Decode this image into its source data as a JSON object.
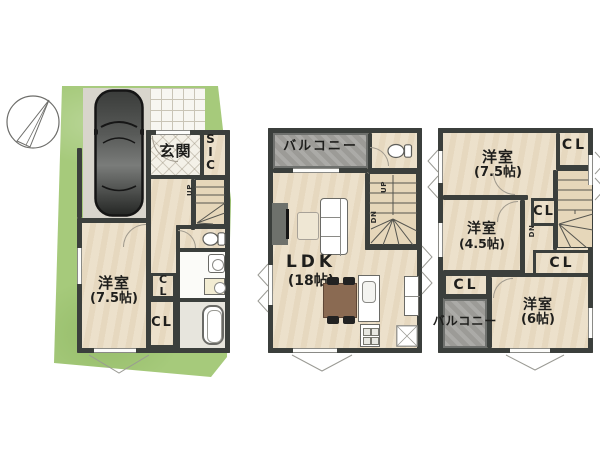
{
  "colors": {
    "lot_green": "#a6ca7b",
    "wall": "#3b3f3c",
    "floor": "#ebdfc8",
    "balcony_gray": "#a2a19d",
    "wood": "#8a6a52"
  },
  "f1": {
    "entrance": "玄関",
    "sic": "SIC",
    "bedroom": "洋室",
    "bedroom_size": "(7.5帖)",
    "closet_a": "CL",
    "closet_b": "CL",
    "up": "UP"
  },
  "f2": {
    "balcony": "バルコニー",
    "ldk": "LDK",
    "ldk_size": "(18帖)",
    "up": "UP",
    "dn": "DN"
  },
  "f3": {
    "bedroom1": "洋室",
    "bedroom1_size": "(7.5帖)",
    "closet_top": "CL",
    "closet_mid": "CL",
    "closet_low": "CL",
    "closet_left": "CL",
    "bedroom2": "洋室",
    "bedroom2_size": "(4.5帖)",
    "bedroom3": "洋室",
    "bedroom3_size": "(6帖)",
    "balcony": "バルコニー",
    "dn": "DN"
  }
}
